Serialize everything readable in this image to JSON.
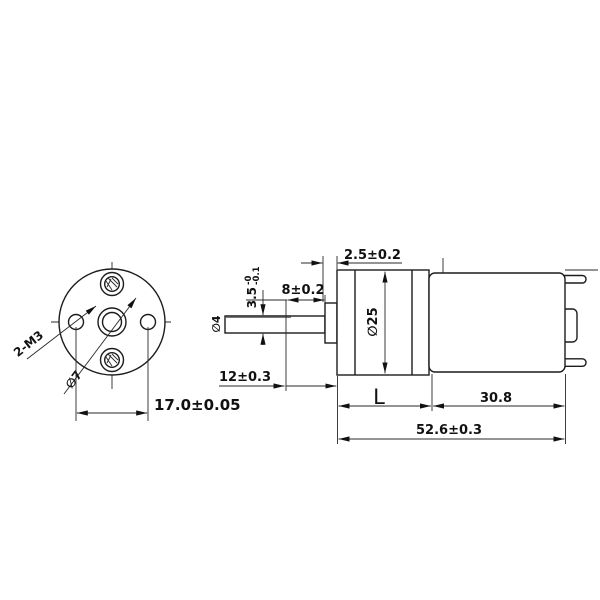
{
  "front": {
    "thread_label": "2-M3",
    "shaft_hole_dia": "∅7",
    "mount_hole_spacing": "17.0±0.05"
  },
  "side": {
    "boss_width": "2.5±0.2",
    "flat_length": "8±0.2",
    "flat_height": "3.5",
    "flat_tol_upper": "-0",
    "flat_tol_lower": "-0.1",
    "shaft_dia": "∅4",
    "body_dia": "∅25",
    "shaft_exposed_length": "12±0.3",
    "gearbox_length": "L",
    "motor_length": "30.8",
    "total_length": "52.6±0.3"
  },
  "colors": {
    "line": "#1c1c1c",
    "background": "#ffffff"
  }
}
